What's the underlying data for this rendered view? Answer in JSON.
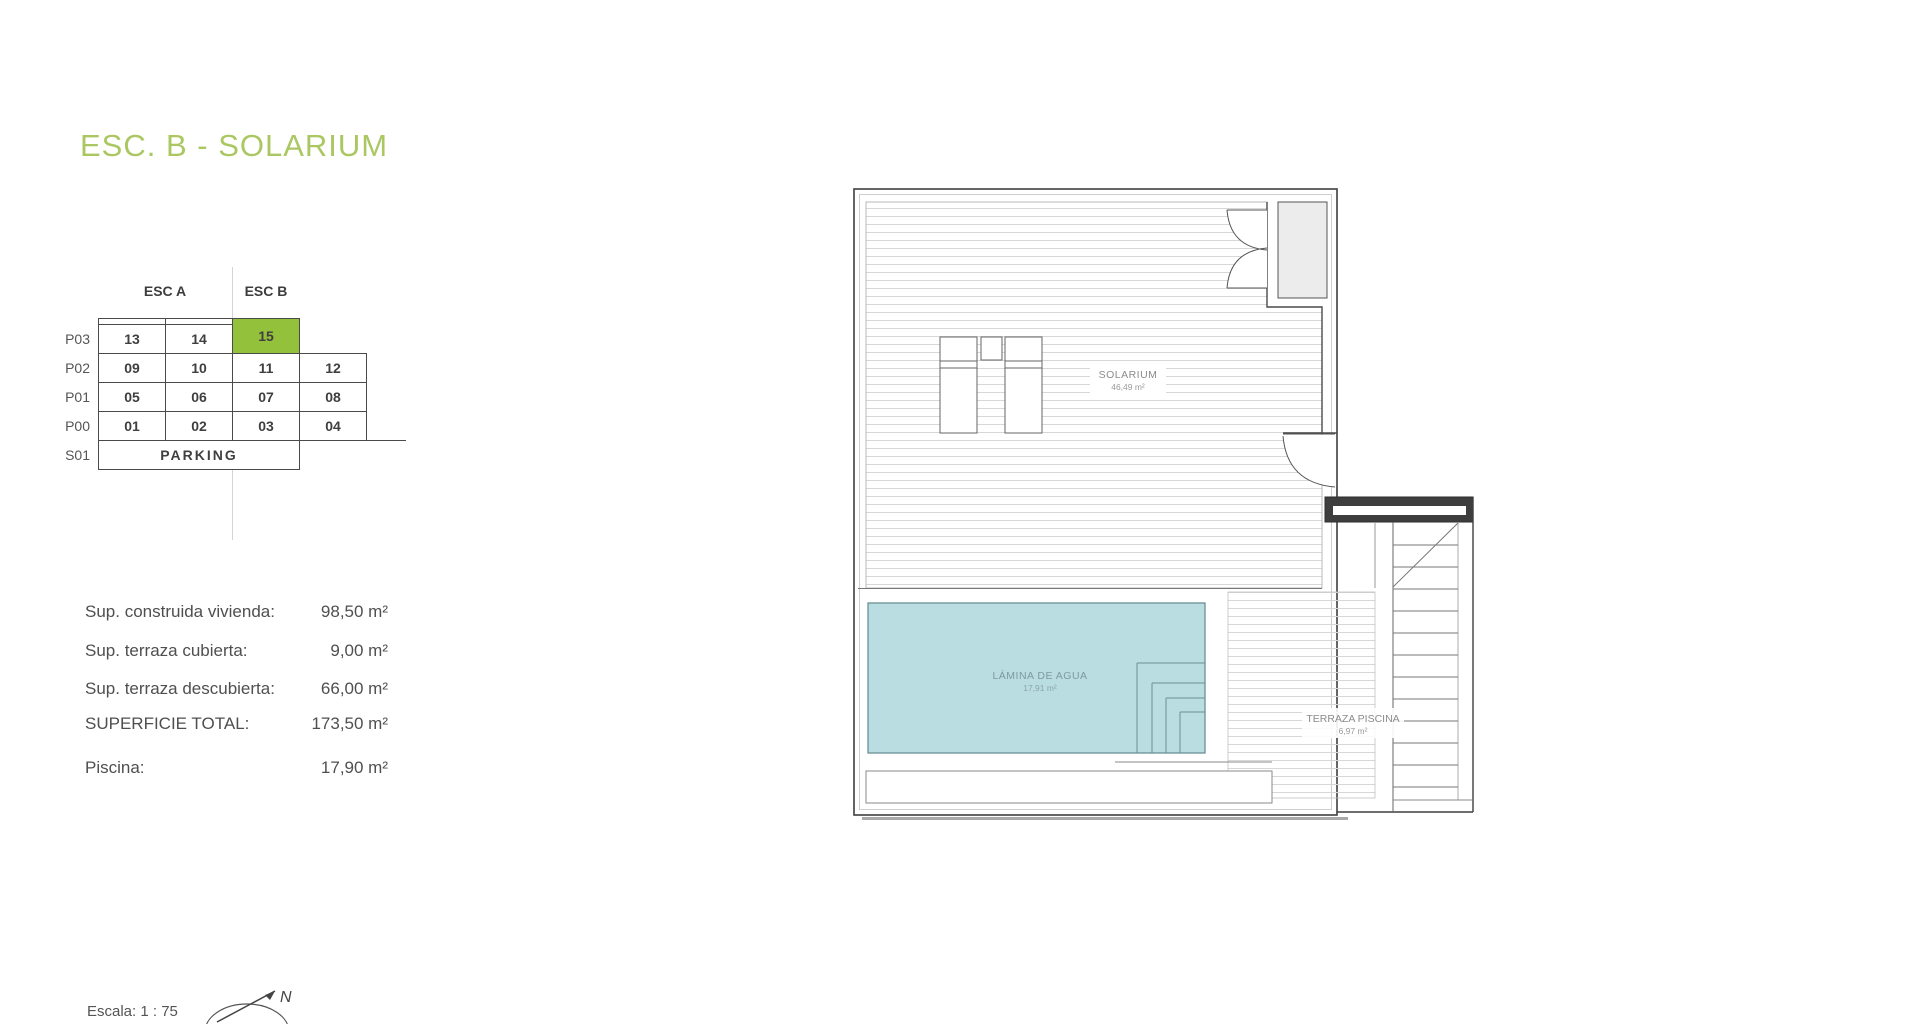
{
  "title": "ESC. B - SOLARIUM",
  "unit_table": {
    "col_headers": [
      "ESC A",
      "ESC B"
    ],
    "rows": [
      {
        "label": "P03",
        "cells": [
          "13",
          "14",
          "15"
        ]
      },
      {
        "label": "P02",
        "cells": [
          "09",
          "10",
          "11",
          "12"
        ]
      },
      {
        "label": "P01",
        "cells": [
          "05",
          "06",
          "07",
          "08"
        ]
      },
      {
        "label": "P00",
        "cells": [
          "01",
          "02",
          "03",
          "04"
        ]
      },
      {
        "label": "S01",
        "cells": [
          "PARKING"
        ]
      }
    ],
    "highlighted_unit": "15",
    "highlight_color": "#94c13c"
  },
  "areas": {
    "rows": [
      {
        "label": "Sup. construida vivienda:",
        "value": "98,50 m²"
      },
      {
        "label": "Sup. terraza cubierta:",
        "value": "9,00 m²"
      },
      {
        "label": "Sup. terraza descubierta:",
        "value": "66,00 m²"
      },
      {
        "label": "SUPERFICIE TOTAL:",
        "value": "173,50 m²"
      },
      {
        "label": "Piscina:",
        "value": "17,90 m²"
      }
    ]
  },
  "plan_labels": {
    "solarium": {
      "name": "SOLARIUM",
      "area": "46,49 m²"
    },
    "pool": {
      "name": "LÁMINA DE AGUA",
      "area": "17,91 m²"
    },
    "pool_terrace": {
      "name": "TERRAZA PISCINA",
      "area": "6,97 m²"
    }
  },
  "scale_label": "Escala: 1 : 75",
  "compass_label": "N",
  "colors": {
    "accent_green": "#abc762",
    "highlight_green": "#94c13c",
    "pool_fill": "#b9dde0",
    "wall_dark": "#3f3f3f"
  }
}
